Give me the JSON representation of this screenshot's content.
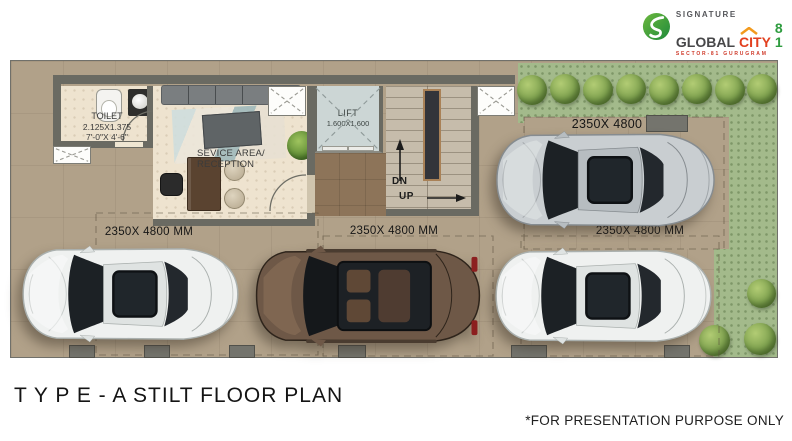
{
  "branding": {
    "signature": "SIGNATURE",
    "global": "GLOBAL",
    "city": "CITY",
    "number": "8 1",
    "tagline": "SECTOR-81 GURUGRAM"
  },
  "plan": {
    "toilet": {
      "name": "TOILET",
      "dim_m": "2.125X1.375",
      "dim_ft": "7'-0\"X 4'-6\""
    },
    "reception": {
      "line1": "SEVICE AREA/",
      "line2": "RECEPTION"
    },
    "lift": {
      "name": "LIFT",
      "dim": "1.600X1.600"
    },
    "stairs": {
      "down": "DN",
      "up": "UP"
    },
    "parking": {
      "top_right": "2350X 4800",
      "bottom_left": "2350X 4800 MM",
      "bottom_center": "2350X 4800 MM",
      "bottom_right": "2350X 4800 MM"
    }
  },
  "footer": {
    "title": "T Y P E - A STILT FLOOR PLAN",
    "disclaimer": "*FOR PRESENTATION PURPOSE ONLY"
  },
  "colors": {
    "floor_tan": "#b1a189",
    "grass_green": "#a3ba8b",
    "wall_gray": "#6b6b63",
    "brand_green": "#2e9c3f",
    "brand_red": "#e2401f",
    "brand_orange": "#f29a1d"
  }
}
